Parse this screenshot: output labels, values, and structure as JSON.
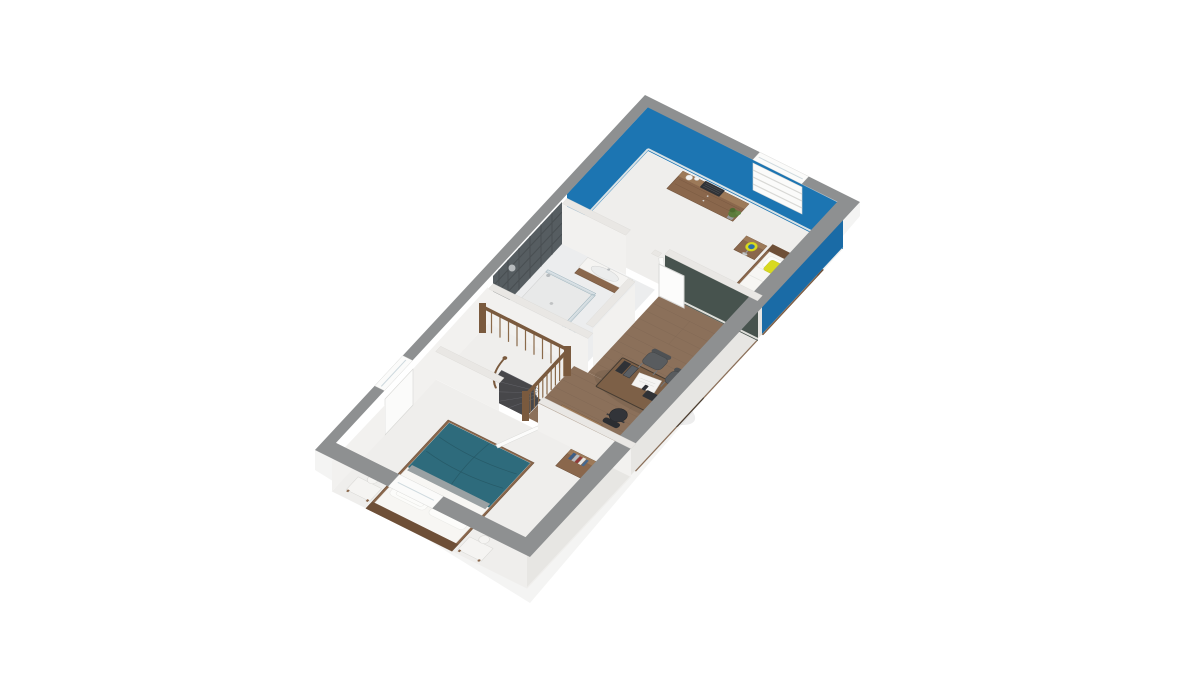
{
  "scene": {
    "type": "3d-floorplan-render",
    "view": "isometric overhead dollhouse view, rotated",
    "description": "3D floor plan of an upper storey with a blue bedroom, bathroom, wooden-floored office landing, curved staircase and a second bedroom with a teal double bed",
    "background_color": "#ffffff"
  },
  "colors": {
    "wall_cap": "#8e9091",
    "partition_cap": "#e9e7e4",
    "blue_wall": "#1c75b2",
    "blue_wall_shade": "#1a6ba6",
    "tile_wall": "#565d61",
    "tile_grout": "#464c50",
    "green_wall": "#47534e",
    "white_wall": "#f2f1ef",
    "white_floor": "#efeeec",
    "bath_floor": "#ecedee",
    "wood_floor": "#8b705a",
    "wood_plank_line": "#7a6250",
    "wood_furniture": "#8a674c",
    "wood_furniture_dark": "#6b4e37",
    "wood_furniture_light": "#9d7a59",
    "bed_linen": "#f7f6f3",
    "teal_duvet": "#2e6b7c",
    "yellow_pillow": "#d8d921",
    "lamp_blue": "#2b6ea9",
    "stair_tread": "#47474a",
    "railing_wood": "#7a5a3e",
    "chair_gray": "#595c5f",
    "office_black": "#303236",
    "plant_green": "#5b7c3c"
  },
  "rooms": [
    {
      "id": "bedroom-blue",
      "wall_color": "#1c75b2",
      "furniture": [
        "single bed with white duvet and yellow pillow",
        "wooden nightstand with yellow-and-blue lamp",
        "chest of drawers with jars, radio and plant",
        "louvered window with white blind"
      ]
    },
    {
      "id": "bathroom",
      "furniture": [
        "dark tiled wall",
        "corner glass shower",
        "wooden vanity with white basin and tap",
        "door to landing"
      ]
    },
    {
      "id": "office-landing",
      "floor": "wood planks",
      "accent_wall": "#47534e",
      "furniture": [
        "desk with monitor, keyboard, mouse, phone, papers and two binders",
        "two grey visitor chairs",
        "black swivel office chair",
        "low wooden sideboard"
      ]
    },
    {
      "id": "staircase",
      "furniture": [
        "curved dark winder treads",
        "wooden balustrade with spindles and newel posts",
        "curved handrail"
      ]
    },
    {
      "id": "bedroom-teal",
      "furniture": [
        "double bed with teal duvet, grey throw and white pillows",
        "two white bedside benches with globe lamps",
        "chest of drawers with books and mugs",
        "white doors",
        "window openings"
      ]
    }
  ],
  "counts": {
    "rooms": 5,
    "windows": 3,
    "doors": 3,
    "beds": 2
  }
}
